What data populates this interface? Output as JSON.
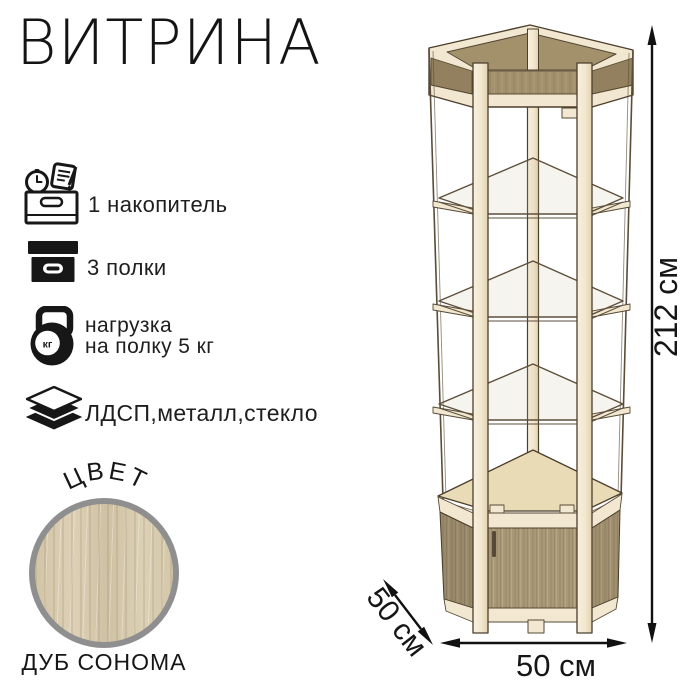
{
  "title": "ВИТРИНА",
  "features": [
    {
      "icon": "storage-drawer-icon",
      "label": "1 накопитель"
    },
    {
      "icon": "shelf-box-icon",
      "label": "3 полки"
    },
    {
      "icon": "kettlebell-icon",
      "line1": "нагрузка",
      "line2": "на полку 5 кг",
      "badge": "кг"
    },
    {
      "icon": "layers-icon",
      "label": "ЛДСП,металл,стекло"
    }
  ],
  "color_section": {
    "heading": "ЦВЕТ",
    "name": "ДУБ СОНОМА"
  },
  "dimensions": {
    "height": "212 см",
    "width": "50 см",
    "depth": "50 см"
  },
  "colors": {
    "frame_cream": "#f2e8d1",
    "accent_tan": "#a3916c",
    "door_wood": "#a89877",
    "cabinet_top_wood": "#e9dbb6",
    "swatch_wood": "#d6c9ad",
    "ring_gray": "#8f8f8f",
    "ink": "#161616"
  }
}
